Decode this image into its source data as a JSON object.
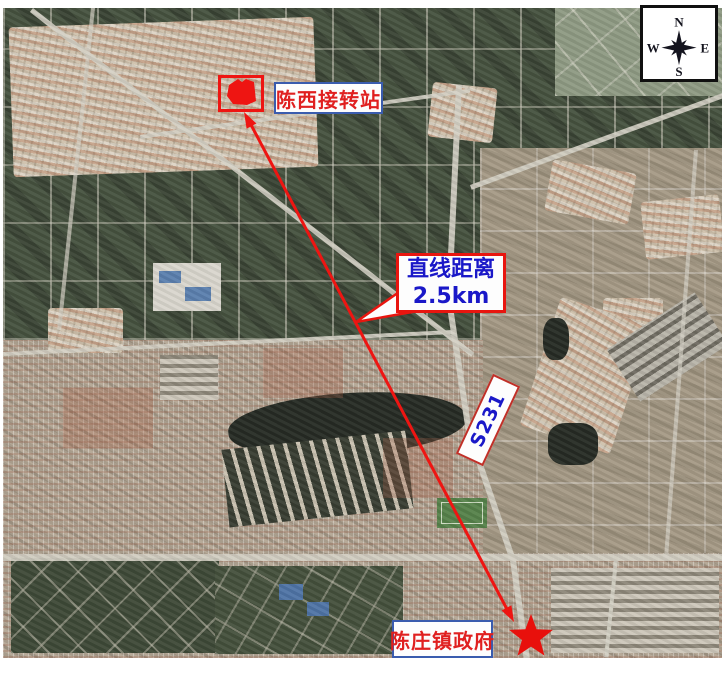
{
  "compass": {
    "north": "N",
    "east": "E",
    "south": "S",
    "west": "W"
  },
  "annotations": {
    "site_label": "陈西接转站",
    "distance_label_line1": "直线距离",
    "distance_label_line2": "2.5km",
    "road_label": "S231",
    "government_label": "陈庄镇政府"
  },
  "colors": {
    "annotation_red": "#e8150f",
    "annotation_blue": "#1a18c8",
    "label_border_blue": "#3a5cae",
    "star_red": "#e8100c",
    "site_rectangle_red": "#ee1512"
  }
}
